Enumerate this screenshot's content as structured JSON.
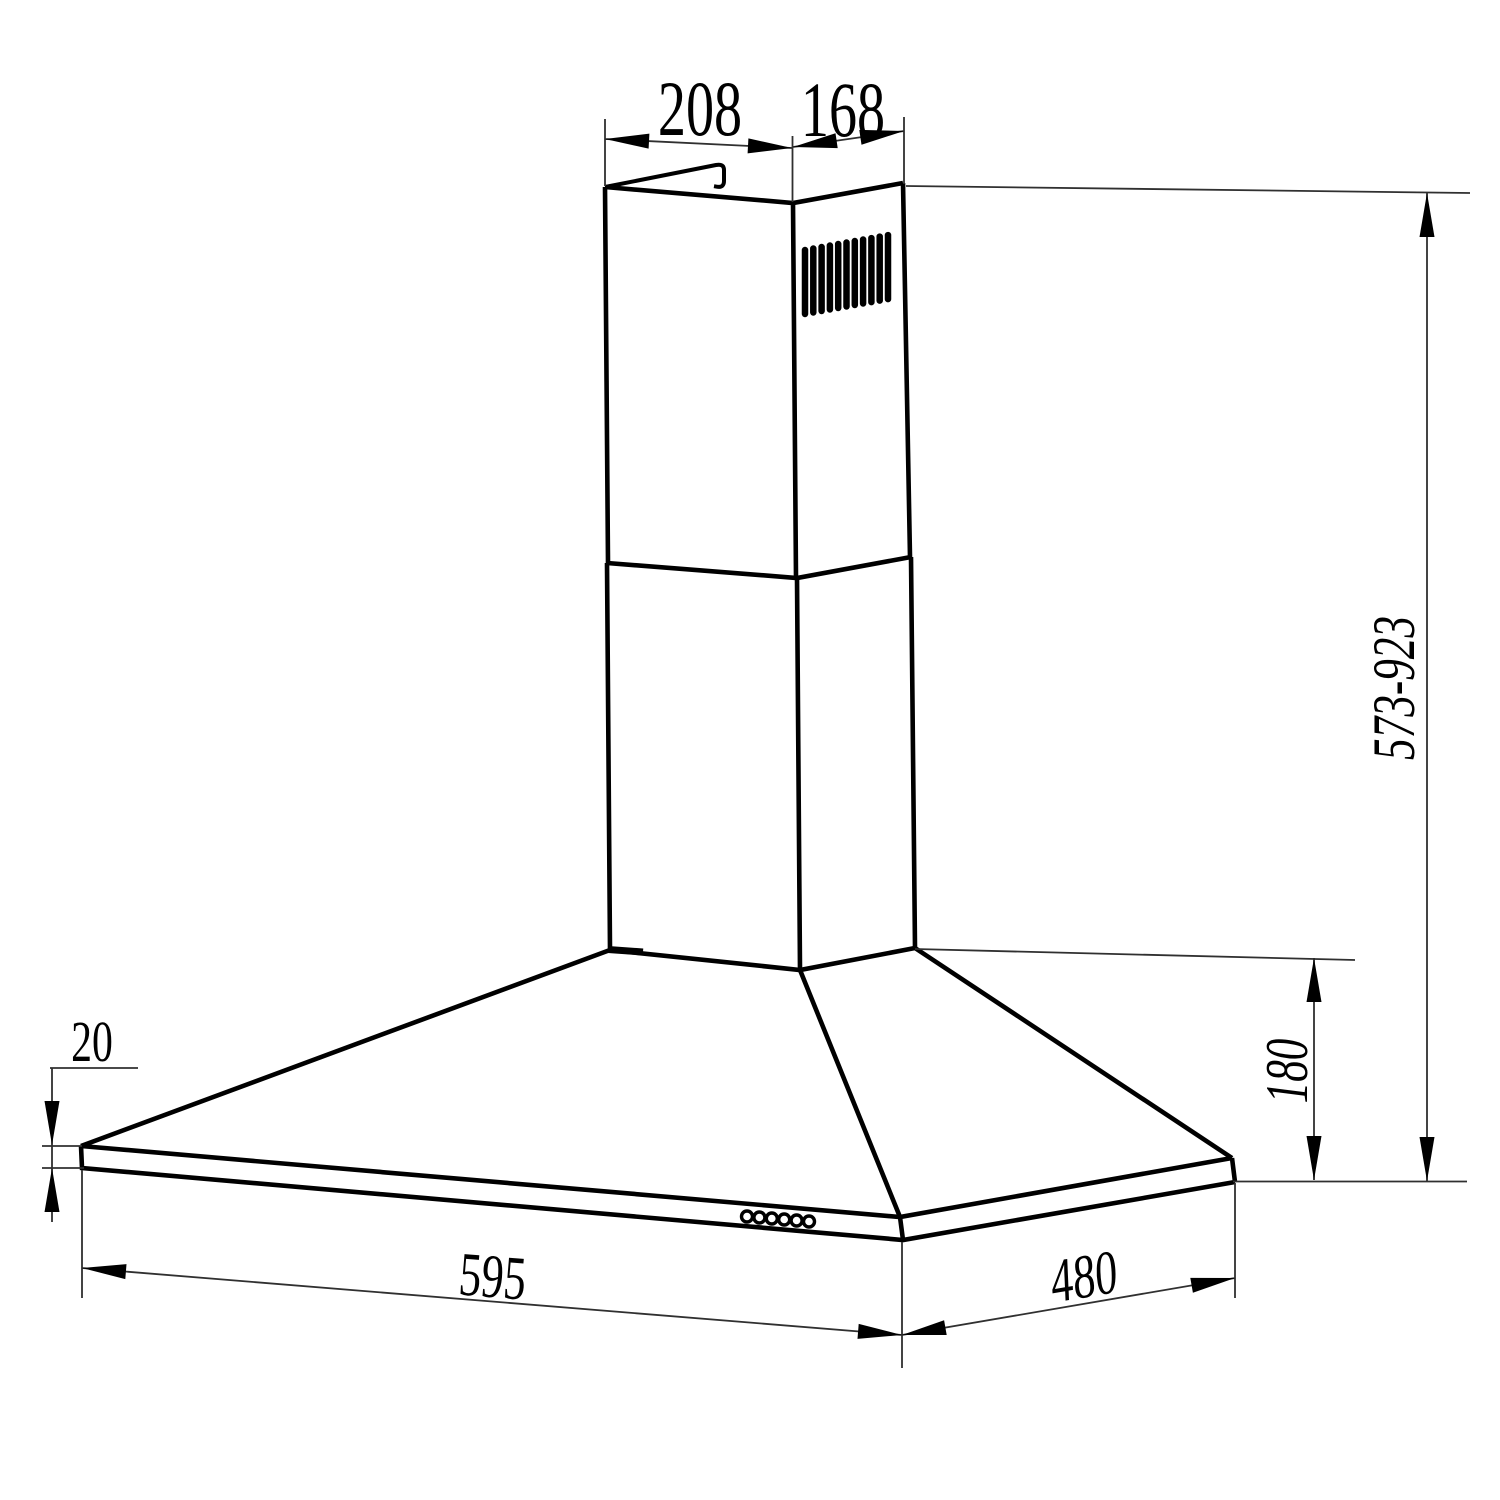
{
  "meta": {
    "title": "Cooker hood technical dimension drawing",
    "units": "mm",
    "line_color": "#000000",
    "background_color": "#ffffff"
  },
  "dims": {
    "chimney_top_width": "208",
    "chimney_top_depth": "168",
    "chimney_height_range": "573-923",
    "canopy_height": "180",
    "rim_thickness": "20",
    "hood_width": "595",
    "hood_depth": "480"
  }
}
